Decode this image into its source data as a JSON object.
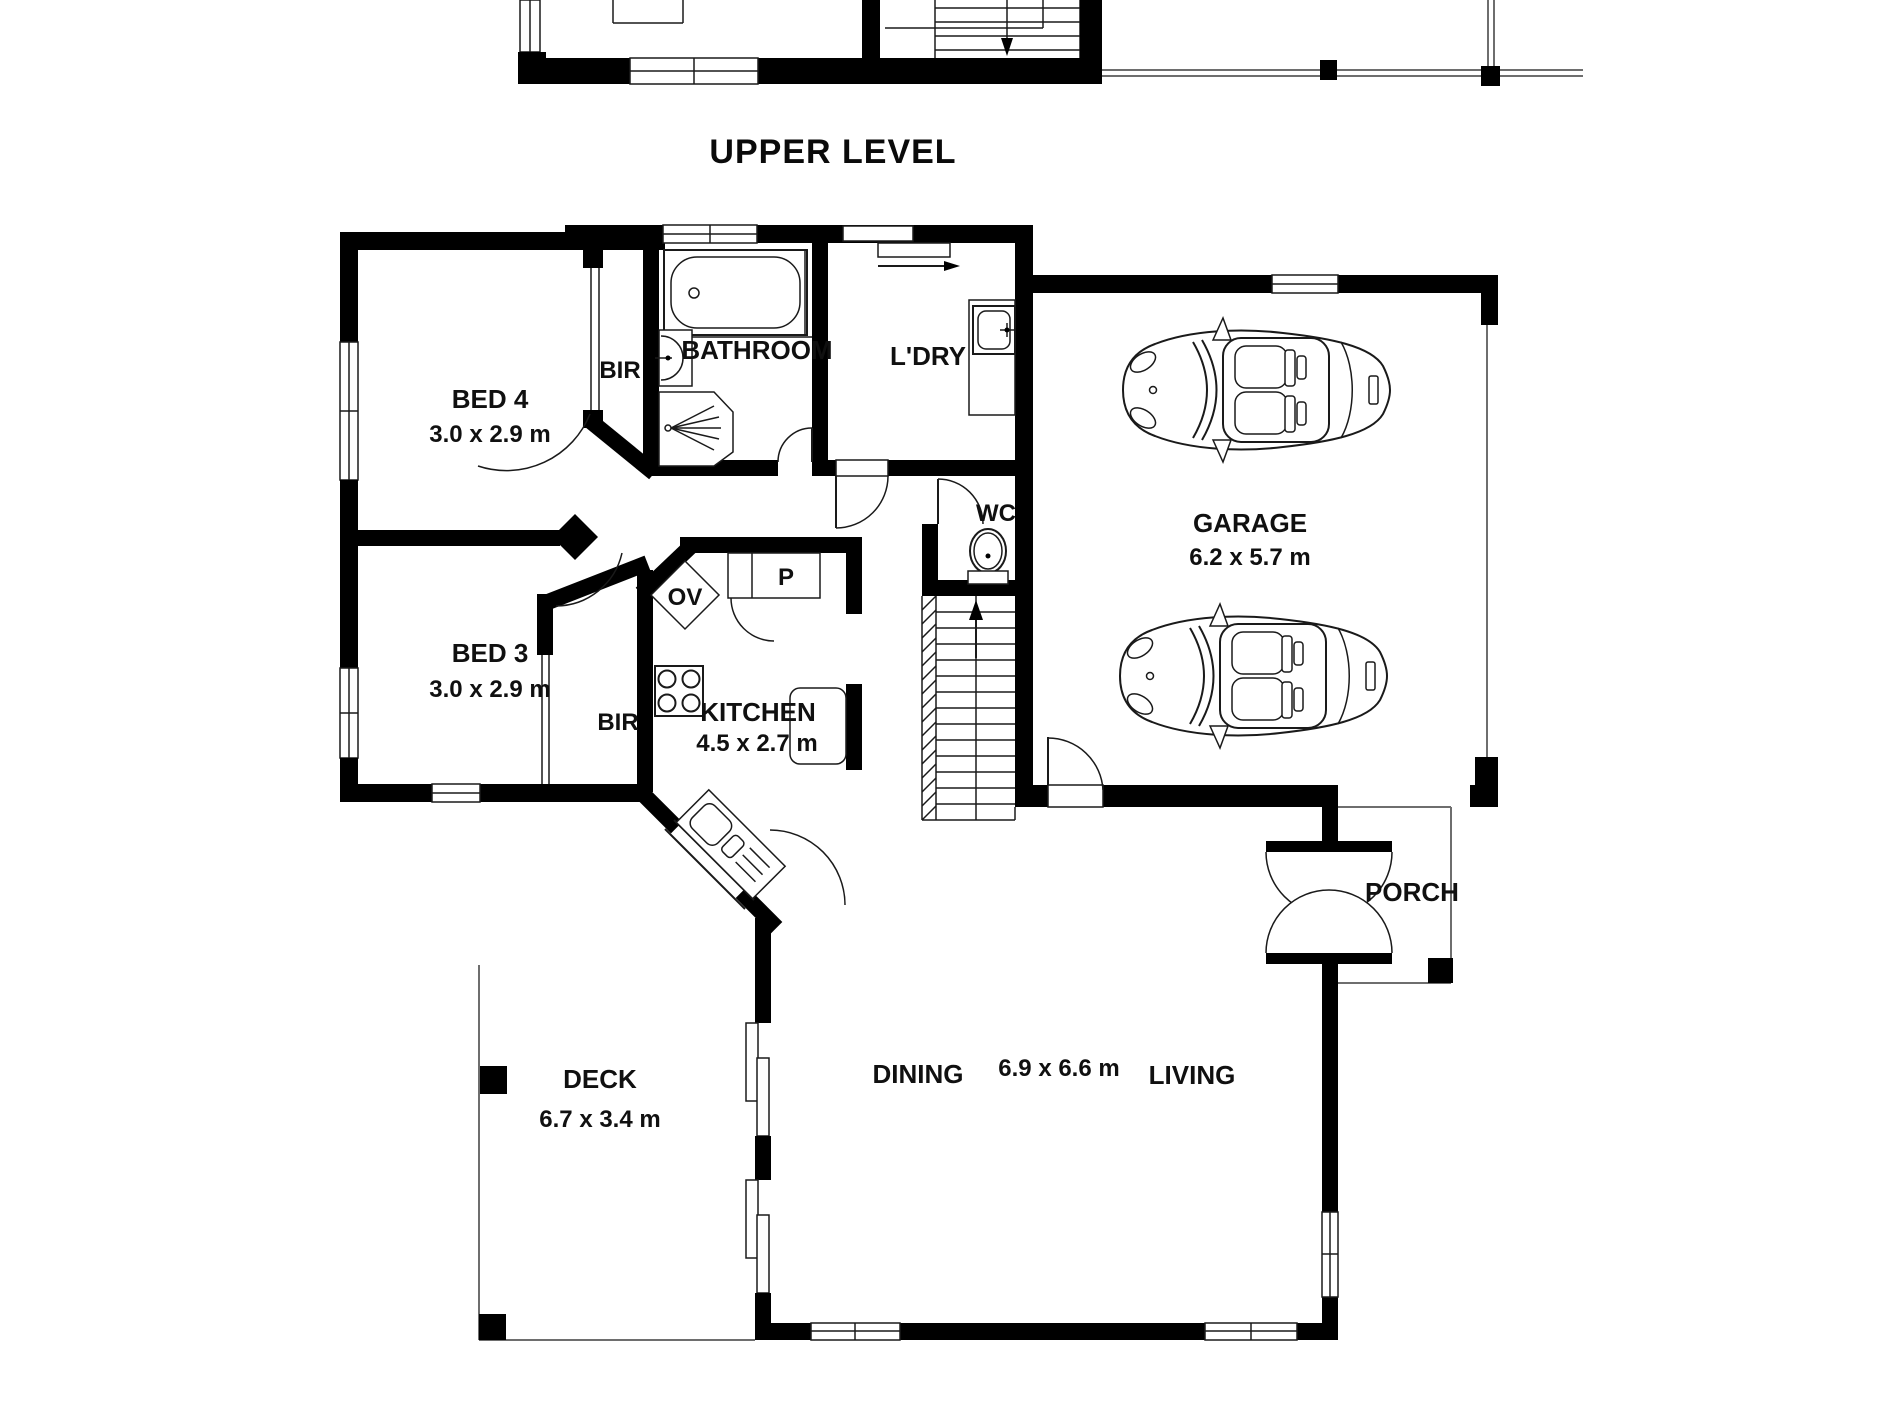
{
  "plan": {
    "title": "UPPER LEVEL",
    "labels": {
      "bed4": "BED 4",
      "bed4_dims": "3.0 x 2.9 m",
      "bed3": "BED 3",
      "bed3_dims": "3.0 x 2.9 m",
      "bir_bed4": "BIR",
      "bir_bed3": "BIR",
      "bathroom": "BATHROOM",
      "laundry": "L'DRY",
      "wc": "WC",
      "garage": "GARAGE",
      "garage_dims": "6.2 x 5.7 m",
      "oven": "OV",
      "pantry": "P",
      "kitchen": "KITCHEN",
      "kitchen_dims": "4.5 x 2.7 m",
      "deck": "DECK",
      "deck_dims": "6.7 x 3.4 m",
      "dining": "DINING",
      "living": "LIVING",
      "living_dining_dims": "6.9 x 6.6 m",
      "porch": "PORCH"
    },
    "colors": {
      "wall": "#000000",
      "line": "#1a1a1a",
      "thin_outline": "#6e6e6e",
      "background": "#ffffff"
    }
  }
}
